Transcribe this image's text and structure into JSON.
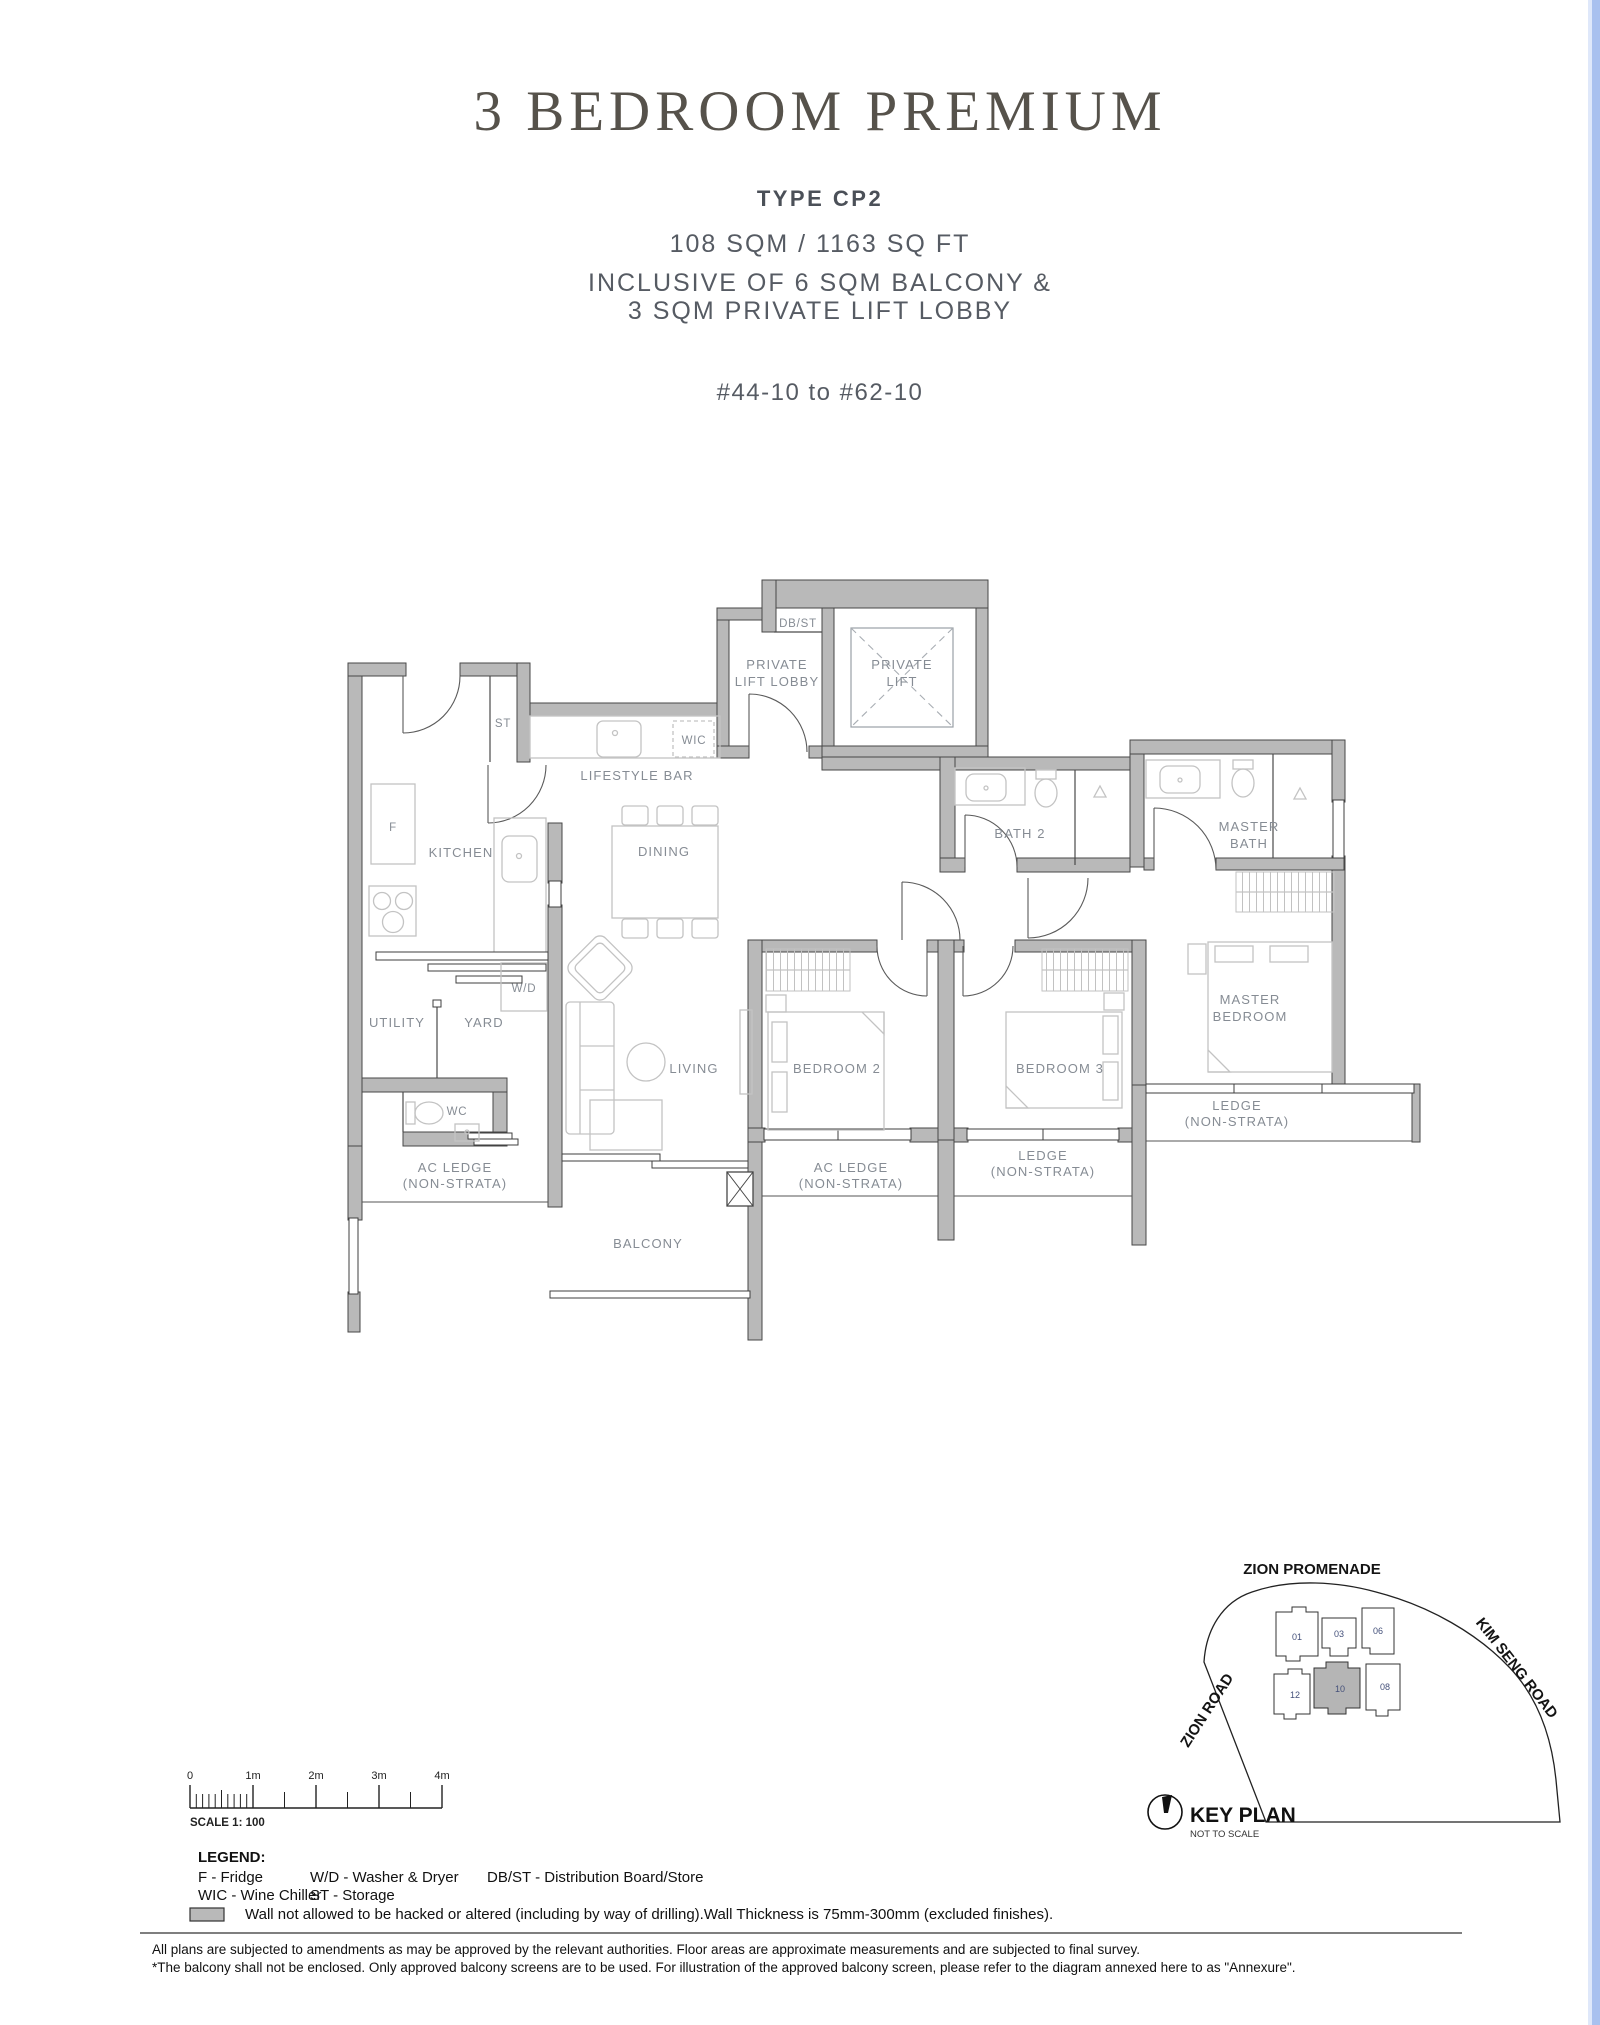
{
  "colors": {
    "wall": "#b9b9b9",
    "plan_label": "#868c94",
    "title_text": "#56524b",
    "body_text": "#565b63",
    "right_strip": "#a9c1ef",
    "highlight_unit_fill": "#b5b5b5"
  },
  "header": {
    "title": "3 BEDROOM PREMIUM",
    "type_label": "TYPE CP2",
    "area": "108 SQM / 1163 SQ FT",
    "inclusive_line1": "INCLUSIVE OF 6 SQM BALCONY &",
    "inclusive_line2": "3 SQM PRIVATE LIFT LOBBY",
    "unit_range": "#44-10 to #62-10"
  },
  "plan": {
    "labels": {
      "db_st": "DB/ST",
      "private_lift_lobby_1": "PRIVATE",
      "private_lift_lobby_2": "LIFT LOBBY",
      "private_lift_1": "PRIVATE",
      "private_lift_2": "LIFT",
      "st": "ST",
      "wic": "WIC",
      "lifestyle_bar": "LIFESTYLE BAR",
      "fridge": "F",
      "kitchen": "KITCHEN",
      "dining": "DINING",
      "bath2": "BATH 2",
      "master_bath_1": "MASTER",
      "master_bath_2": "BATH",
      "washer_dryer": "W/D",
      "utility": "UTILITY",
      "yard": "YARD",
      "wc": "WC",
      "living": "LIVING",
      "bedroom2": "BEDROOM 2",
      "bedroom3": "BEDROOM 3",
      "master_bedroom_1": "MASTER",
      "master_bedroom_2": "BEDROOM",
      "ledge_1": "LEDGE",
      "ledge_2": "(NON-STRATA)",
      "ac_ledge_1": "AC LEDGE",
      "ac_ledge_2": "(NON-STRATA)",
      "balcony": "BALCONY"
    }
  },
  "scale_bar": {
    "tick_labels": [
      "0",
      "1m",
      "2m",
      "3m",
      "4m"
    ],
    "scale_text": "SCALE 1:  100"
  },
  "legend": {
    "heading": "LEGEND:",
    "item_f": "F - Fridge",
    "item_wd": "W/D - Washer & Dryer",
    "item_dbst": "DB/ST - Distribution Board/Store",
    "item_wic": "WIC - Wine Chiller",
    "item_st": "ST - Storage",
    "wall_note": "Wall not allowed to be hacked or altered (including by way of drilling).Wall Thickness is 75mm-300mm (excluded finishes)."
  },
  "key_plan": {
    "zion_promenade": "ZION PROMENADE",
    "kim_seng_road": "KIM SENG ROAD",
    "zion_road": "ZION ROAD",
    "title": "KEY PLAN",
    "subtitle": "NOT TO SCALE",
    "units": [
      "01",
      "03",
      "06",
      "12",
      "10",
      "08"
    ],
    "highlighted_unit": "10"
  },
  "footer": {
    "line1": "All plans are subjected to amendments as may be approved by the relevant authorities. Floor areas are approximate measurements and are subjected to final survey.",
    "line2": "*The balcony shall not be enclosed. Only approved balcony screens are to be used. For illustration of the approved balcony screen, please refer to the diagram annexed here to as \"Annexure\"."
  }
}
